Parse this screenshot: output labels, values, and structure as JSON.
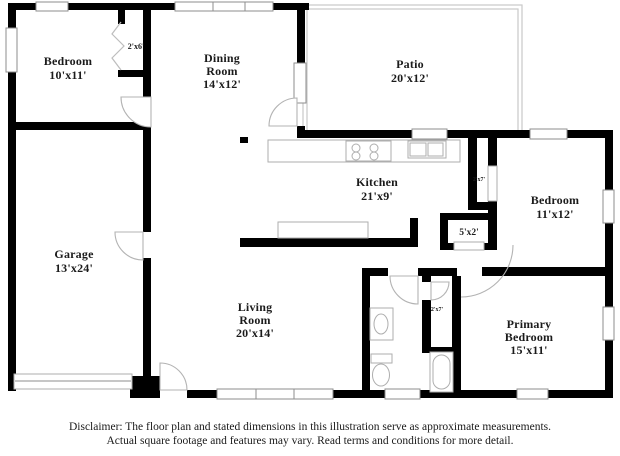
{
  "floorplan": {
    "rooms": [
      {
        "id": "bedroom-top-left",
        "lines": [
          "Bedroom",
          "10'x11'"
        ]
      },
      {
        "id": "dining-room",
        "lines": [
          "Dining",
          "Room",
          "14'x12'"
        ]
      },
      {
        "id": "patio",
        "lines": [
          "Patio",
          "20'x12'"
        ]
      },
      {
        "id": "kitchen",
        "lines": [
          "Kitchen",
          "21'x9'"
        ]
      },
      {
        "id": "bedroom-right",
        "lines": [
          "Bedroom",
          "11'x12'"
        ]
      },
      {
        "id": "garage",
        "lines": [
          "Garage",
          "13'x24'"
        ]
      },
      {
        "id": "living-room",
        "lines": [
          "Living",
          "Room",
          "20'x14'"
        ]
      },
      {
        "id": "primary-bedroom",
        "lines": [
          "Primary",
          "Bedroom",
          "15'x11'"
        ]
      }
    ],
    "closets": [
      {
        "id": "closet-2x6",
        "label": "2'x6'"
      },
      {
        "id": "closet-2x7-kitchen",
        "label": "2'x7'"
      },
      {
        "id": "closet-5x2",
        "label": "5'x2'"
      },
      {
        "id": "closet-2x7-hall",
        "label": "2'x7'"
      }
    ],
    "colors": {
      "wall": "#000000",
      "window_stroke": "#8e8e8e",
      "fixture_stroke": "#aeaeae",
      "patio_stroke": "#c9c9c9",
      "text": "#1b1b1b"
    }
  },
  "disclaimer": {
    "line1": "Disclaimer: The floor plan and stated dimensions in this illustration serve as approximate measurements.",
    "line2": "Actual square footage and features may vary. Read terms and conditions for more detail."
  }
}
